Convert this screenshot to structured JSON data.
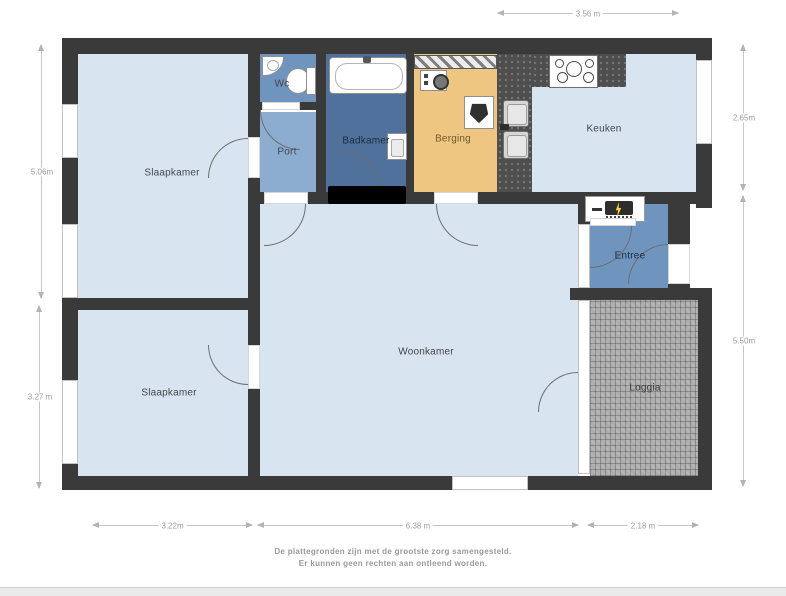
{
  "floorplan": {
    "rooms": [
      {
        "name": "slaapkamer-1",
        "label": "Slaapkamer"
      },
      {
        "name": "slaapkamer-2",
        "label": "Slaapkamer"
      },
      {
        "name": "wc",
        "label": "Wc"
      },
      {
        "name": "port",
        "label": "Port"
      },
      {
        "name": "badkamer",
        "label": "Badkamer"
      },
      {
        "name": "berging",
        "label": "Berging"
      },
      {
        "name": "keuken",
        "label": "Keuken"
      },
      {
        "name": "entree",
        "label": "Entree"
      },
      {
        "name": "woonkamer",
        "label": "Woonkamer"
      },
      {
        "name": "loggia",
        "label": "Loggia"
      }
    ],
    "dimensions": {
      "top": "3.56 m",
      "left_upper": "5.06m",
      "left_lower": "3.27 m",
      "right_upper": "2.65m",
      "right_lower": "5.50m",
      "bottom_left": "3.22m",
      "bottom_middle": "6.38 m",
      "bottom_right": "2.18 m"
    },
    "disclaimer": {
      "line1": "De plattegronden zijn met de grootste zorg samengesteld.",
      "line2": "Er kunnen geen rechten aan ontleend worden."
    },
    "colors": {
      "wall": "#3a3a3a",
      "room_light": "#d9e4f1",
      "room_medium": "#6f95bf",
      "room_port": "#8cadd0",
      "room_bath": "#50719b",
      "room_storage": "#eec681",
      "counter": "#4e4e4e",
      "tile": "#aeaeae"
    }
  }
}
